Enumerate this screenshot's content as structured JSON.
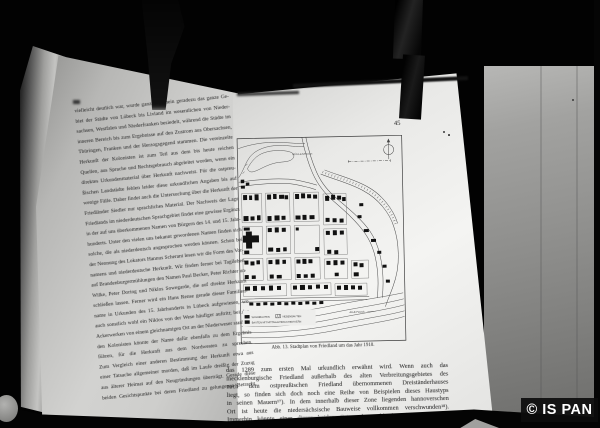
{
  "photo": {
    "watermark": "© IS PAN",
    "description": "photograph of an open book held by clamps"
  },
  "colors": {
    "background": "#020202",
    "paper_left": "#c4c4c2",
    "paper_right": "#efefed",
    "backing_board": "#8e8e8c",
    "ink": "#1a1a1a",
    "watermark_text": "#ffffff"
  },
  "left_page": {
    "text_lines": [
      "vielleicht deutlich war, wurde ganz allgemein geradezu das ganze Ge-",
      "biet der Städte von Lübeck bis Livland im wesentlichen von Nieder-",
      "sachsen, Westfalen und Niederfranken besiedelt, während die Städte im",
      "inneren Bereich bis zum Ergebnisse auf den Zustrom aus Obersachsen,",
      "Thüringen, Franken und der Herzogsgegend stammen. Die vereinzelte",
      "Herkunft der Kolonisten ist zum Teil aus dem bis heute reichen",
      "Quellen, aus Sprache und Rechtsgebrauch abgeleitet worden, wenn ein",
      "direktes Urkundenmaterial über Herkunft nachweist. Für die ostpreu-",
      "ßischen Landstädte fehlen leider diese urkundlichen Angaben bis auf",
      "wenige Fälle. Daher findet auch die Untersuchung über die Herkunft der",
      "Friedländer Siedler nur sprachliches Material. Der Nachweis der Lage",
      "Friedlands im niederdeutschen Sprachgebiet findet eine gewisse Ergänzung",
      "in der auf uns überkommenen Namen von Bürgern des 14. und 15. Jahr-",
      "hunderts. Unter den vielen uns bekannt gewordenen Namen finden sich",
      "solche, die als niederdeutsch angesprochen werden können. Schon bei",
      "der Nennung des Lokators Hannus Scherant lesen wir die Form des Vor-",
      "namens und niederdeutsche Herkunft. Wir finden ferner bei Tagileben",
      "auf Brandenburgermühlungen den Namen Paul Becker, Peter Richter und",
      "Wilke, Peter Doring und Niklos Sowegarde, die auf direkte Herkunft",
      "schließen lassen. Ferner wird ein Hans Rense gerade dieser Familien-",
      "name in Urkunden des 15. Jahrhunderts in Lübeck aufgewiesen, wo",
      "auch sonstlich wohl ein Niklos von der Wese häufiger auftritt; bei den",
      "Ackerwerken von einem gleichnamigen Ort an der Niederweser stammen-",
      "den Kolonisten könnte der Name dafür ebenfalls zu dem Ergebnis",
      "führen, für die Herkunft aus dem Nordwesten zu sprechen.",
      "Zum Vergleich einer anderen Bestimmung der Herkunft etwa aus",
      "einer Tatsache allgemeiner morden, daß im Laufe dreißig der Zuzug",
      "aus älterer Heimat auf den Neugründungen überträgt. Gerade diese",
      "beiden Gesichtspunkte bei deren Friedland zu gelungenen Betracht."
    ]
  },
  "right_page": {
    "page_number": "45",
    "figure": {
      "caption": "Abb. 13. Stadtplan von Friedland um das Jahr 1910.",
      "pond_label": "MÜHLENTEICH",
      "river_label": "ALLE-FLUSS",
      "legend": [
        {
          "symbol": "filled-square",
          "label": "WOHNBAUTEN"
        },
        {
          "symbol": "hatched-square",
          "label": "NEBENBAUTEN"
        },
        {
          "symbol": "filled-square",
          "label": "BAUTEN MIT MITTELALTERLICHEM KERN"
        }
      ]
    },
    "body_lines": [
      "das 1289 zum ersten Mal urkundlich erwähnt wird. Wenn auch das",
      "mecklenburgische Friedland außerhalb des alten Verbreitungsgebietes des",
      "nach dem ostpreußischen Friedland übernommenen Dreiständerhauses",
      "liegt, so finden sich doch noch eine Reihe von Beispielen dieses Haustyps",
      "in seinen Mauern¹⁷). In dem innerhalb dieser Zone liegenden hannoverschen",
      "Ort ist heute die niedersächsische Bauweise vollkommen verschwunden¹⁸).",
      "Immerhin könnte einer dieser beiden Orte sehr wohl die alte Heimat der"
    ]
  }
}
